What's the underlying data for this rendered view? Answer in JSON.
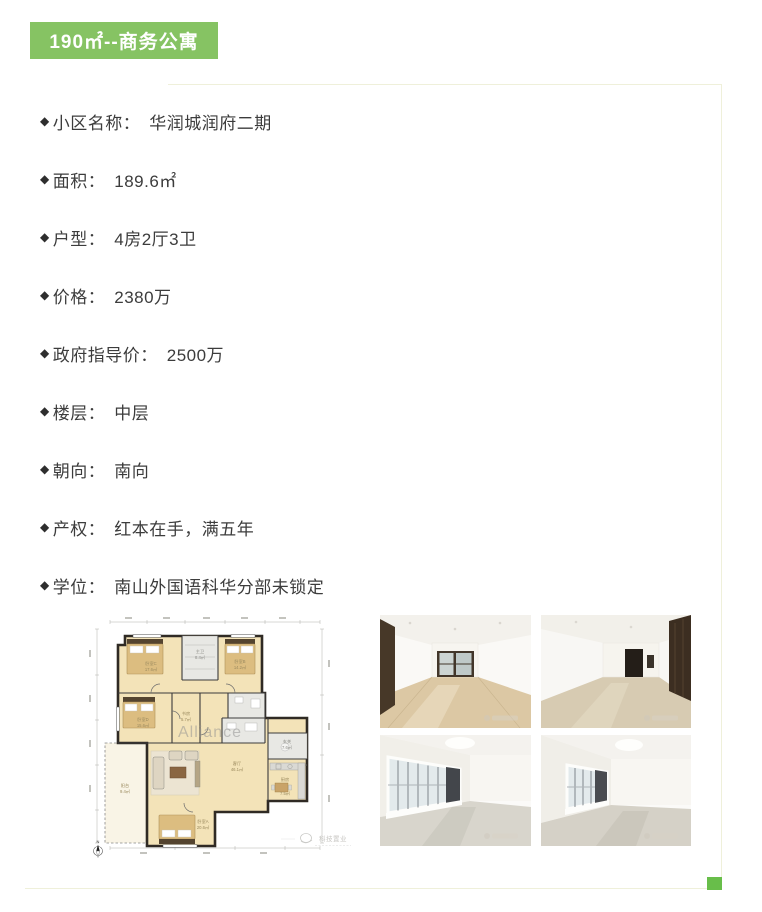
{
  "page": {
    "frame_color": "#eff0da",
    "corner_accent_color": "#68be4a",
    "background": "#ffffff"
  },
  "header": {
    "badge_label": "190㎡--商务公寓",
    "badge_bg": "#86c363",
    "badge_text_color": "#ffffff"
  },
  "listing": {
    "bullet": "◆",
    "separator": "：",
    "items": [
      {
        "label": "小区名称",
        "value": "华润城润府二期"
      },
      {
        "label": "面积",
        "value": "189.6㎡"
      },
      {
        "label": "户型",
        "value": "4房2厅3卫"
      },
      {
        "label": "价格",
        "value": "2380万"
      },
      {
        "label": "政府指导价",
        "value": "2500万"
      },
      {
        "label": "楼层",
        "value": "中层"
      },
      {
        "label": "朝向",
        "value": "南向"
      },
      {
        "label": "产权",
        "value": "红本在手，满五年"
      },
      {
        "label": "学位",
        "value": "南山外国语科华分部未锁定"
      }
    ]
  },
  "floorplan": {
    "watermark": "Alliance",
    "agency_watermark": "科技置业",
    "compass_label": "N",
    "rooms": [
      {
        "name": "卧室C",
        "area": "17.6㎡"
      },
      {
        "name": "主卫",
        "area": "8.4㎡"
      },
      {
        "name": "卧室B",
        "area": "14.2㎡"
      },
      {
        "name": "卧室D",
        "area": "15.6㎡"
      },
      {
        "name": "书房",
        "area": "5.7㎡"
      },
      {
        "name": "客厅",
        "area": "46.1㎡"
      },
      {
        "name": "玄关",
        "area": "7.6㎡"
      },
      {
        "name": "厨房",
        "area": "7.5㎡"
      },
      {
        "name": "卧室A",
        "area": "20.6㎡"
      },
      {
        "name": "阳台",
        "area": "9.4㎡"
      }
    ]
  },
  "photos": {
    "items": [
      {
        "id": "living-room-photo-a"
      },
      {
        "id": "living-room-photo-b"
      },
      {
        "id": "bedroom-photo-a"
      },
      {
        "id": "bedroom-photo-b"
      }
    ]
  }
}
